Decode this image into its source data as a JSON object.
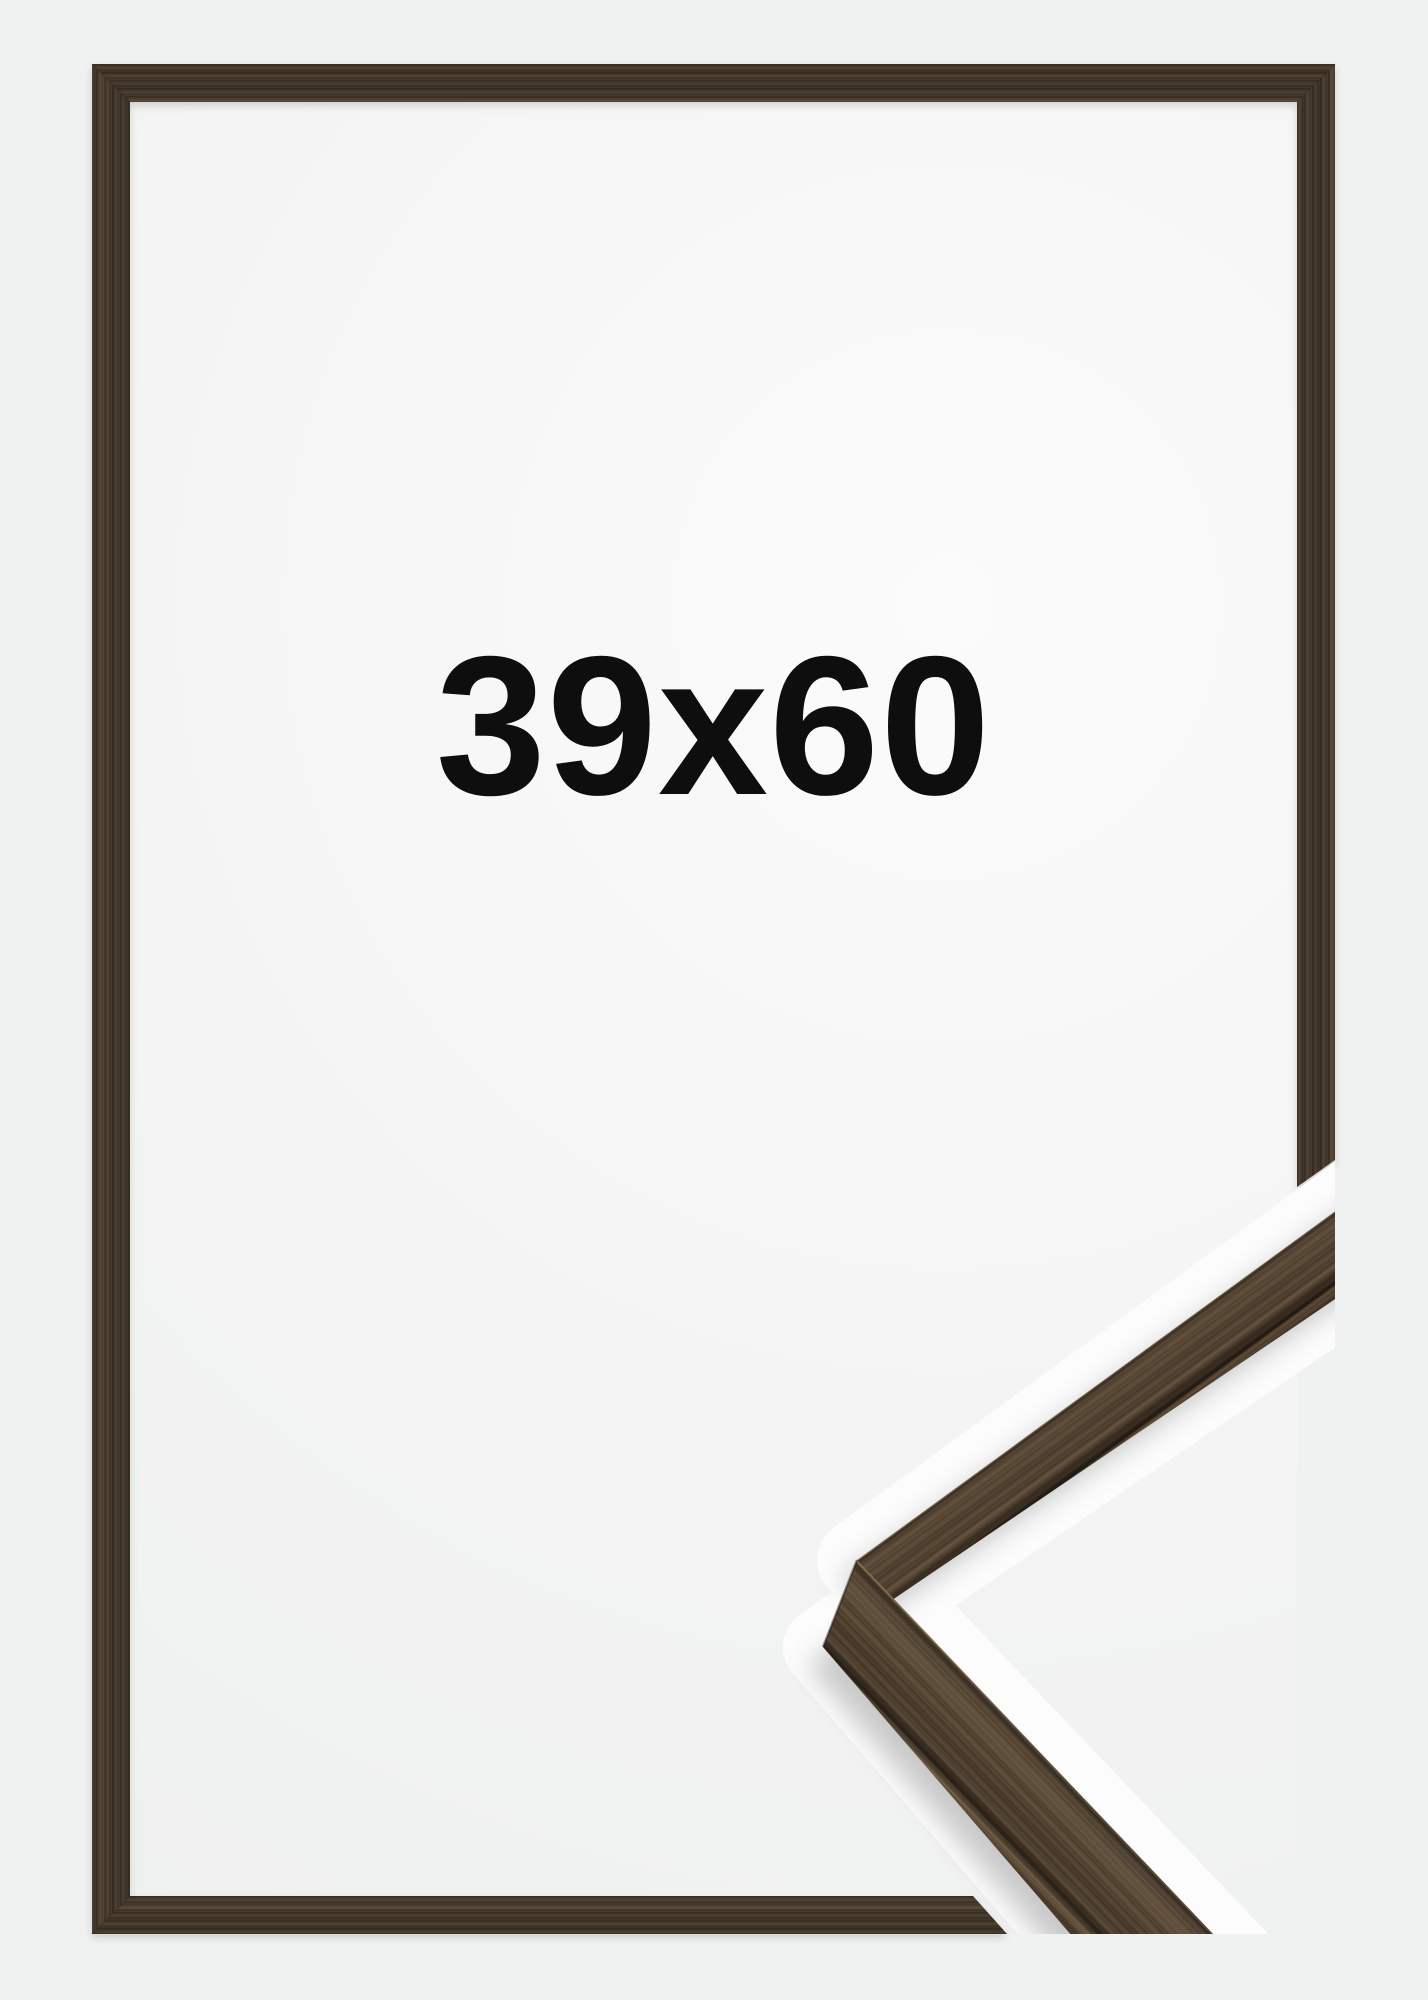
{
  "page": {
    "background_color": "#f0f1f1"
  },
  "product": {
    "size_label": "39x60",
    "label_color": "#0e0e0e",
    "frame_wood_color": "#463a2d",
    "frame_wood_dark": "#2e2620",
    "frame_wood_light": "#5d4c3a",
    "detail_wood_color": "#594836",
    "detail_wood_light": "#93805f",
    "detail_wood_dark": "#231b14",
    "interior_color": "#fbfbfb",
    "halo_color": "#fcfcfd"
  }
}
